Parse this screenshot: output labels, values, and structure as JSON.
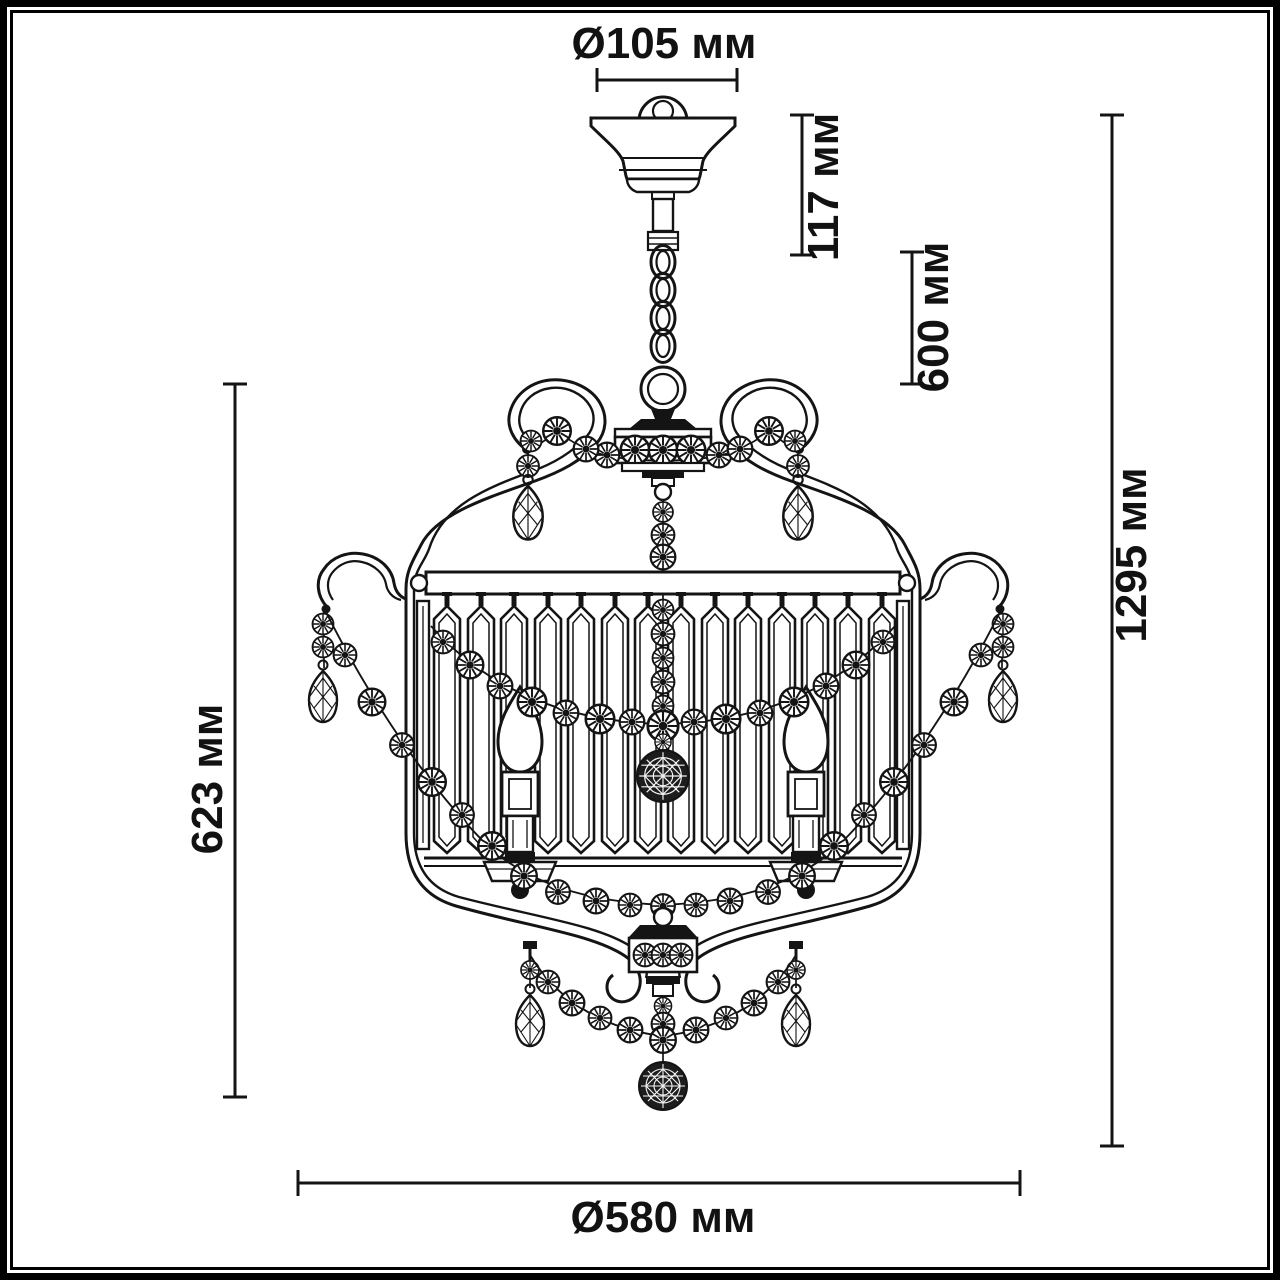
{
  "figure": {
    "type": "technical-line-drawing",
    "subject": "crystal chandelier front view",
    "parts": [
      "ceiling-canopy",
      "hanging-chain",
      "suspension-ring",
      "upper-hub",
      "scroll-arms",
      "crystal-rosette-garlands",
      "teardrop-pendants",
      "crystal-prism-shade",
      "candle-bulbs",
      "bottom-finial",
      "faceted-crystal-balls",
      "bead-swags"
    ]
  },
  "annotations": {
    "canopy_diameter": {
      "label": "Ø105 мм"
    },
    "canopy_height": {
      "label": "117 мм"
    },
    "chain_length": {
      "label": "600 мм"
    },
    "total_height": {
      "label": "1295 мм"
    },
    "body_height": {
      "label": "623 мм"
    },
    "body_diameter": {
      "label": "Ø580 мм"
    }
  },
  "style": {
    "line_color": "#141414",
    "background": "#ffffff"
  }
}
